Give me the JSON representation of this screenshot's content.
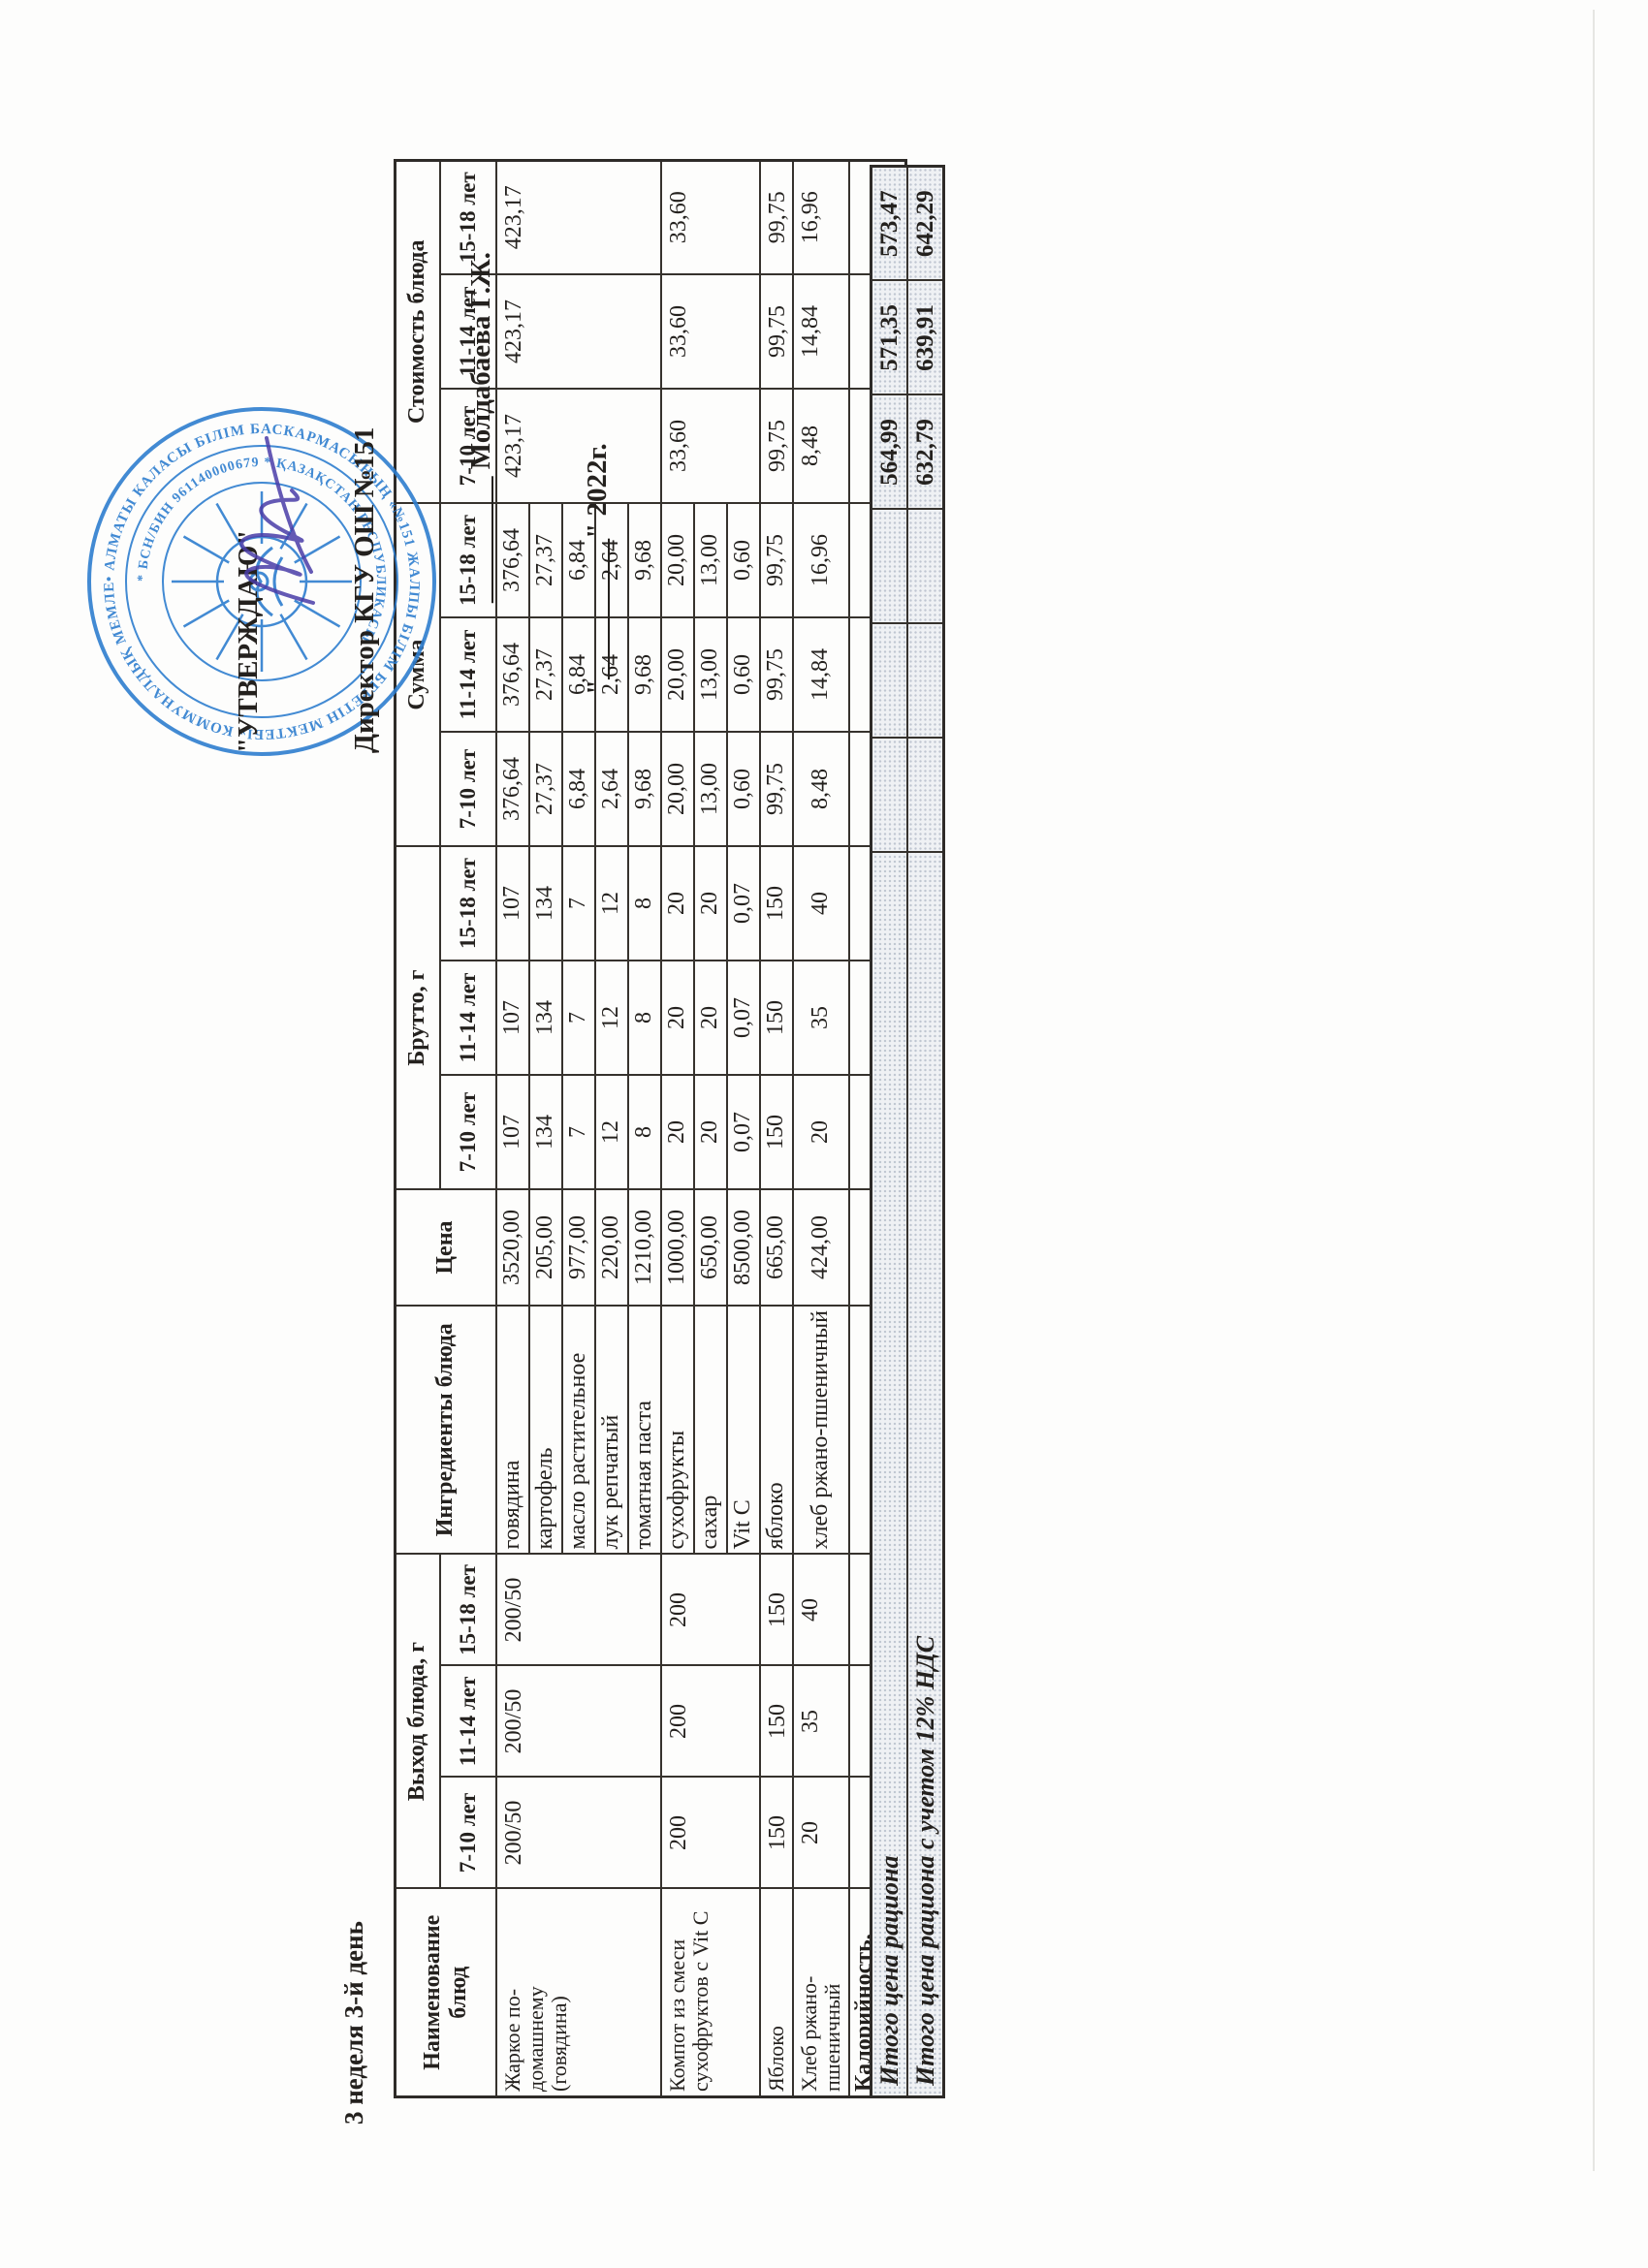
{
  "page": {
    "title": "3 неделя 3-й день"
  },
  "approval": {
    "line1": "\"УТВЕРЖДАЮ\"",
    "line2": "Директор КГУ ОШ №151",
    "line3": "_________ Молдабаева Г.Ж.",
    "line4": "\"__________\" 2022г."
  },
  "seal": {
    "color": "#2e7ecf",
    "ring_outer_text": "• АЛМАТЫ КАЛАСЫ БІЛІМ БАСКАРМАСЫНЫҢ «№151 ЖАЛПЫ БІЛІМ БЕРЕТІН МЕКТЕБІ» КОММУНАЛДЫҚ МЕМЛЕКЕТТІК МЕКЕМЕСІ •",
    "ring_inner_text": "* БСН/БИН 961140000679 * ҚАЗАҚСТАН РЕСПУБЛИКАСЫ"
  },
  "table": {
    "headers": {
      "name": "Наименование блюд",
      "yield": "Выход блюда, г",
      "ingredients": "Ингредиенты блюда",
      "price": "Цена",
      "brutto": "Брутто, г",
      "sum": "Сумма",
      "cost": "Стоимость блюда"
    },
    "age_groups": [
      "7-10 лет",
      "11-14 лет",
      "15-18 лет"
    ],
    "dishes": [
      {
        "name": "Жаркое по-домашнему (говядина)",
        "yield": [
          "200/50",
          "200/50",
          "200/50"
        ],
        "cost": [
          "423,17",
          "423,17",
          "423,17"
        ],
        "ingredients": [
          {
            "name": "говядина",
            "price": "3520,00",
            "brutto": [
              "107",
              "107",
              "107"
            ],
            "sum": [
              "376,64",
              "376,64",
              "376,64"
            ]
          },
          {
            "name": "картофель",
            "price": "205,00",
            "brutto": [
              "134",
              "134",
              "134"
            ],
            "sum": [
              "27,37",
              "27,37",
              "27,37"
            ]
          },
          {
            "name": "масло растительное",
            "price": "977,00",
            "brutto": [
              "7",
              "7",
              "7"
            ],
            "sum": [
              "6,84",
              "6,84",
              "6,84"
            ]
          },
          {
            "name": "лук репчатый",
            "price": "220,00",
            "brutto": [
              "12",
              "12",
              "12"
            ],
            "sum": [
              "2,64",
              "2,64",
              "2,64"
            ]
          },
          {
            "name": "томатная паста",
            "price": "1210,00",
            "brutto": [
              "8",
              "8",
              "8"
            ],
            "sum": [
              "9,68",
              "9,68",
              "9,68"
            ]
          }
        ]
      },
      {
        "name": "Компот из смеси сухофруктов с Vit C",
        "yield": [
          "200",
          "200",
          "200"
        ],
        "cost": [
          "33,60",
          "33,60",
          "33,60"
        ],
        "ingredients": [
          {
            "name": "сухофрукты",
            "price": "1000,00",
            "brutto": [
              "20",
              "20",
              "20"
            ],
            "sum": [
              "20,00",
              "20,00",
              "20,00"
            ]
          },
          {
            "name": "сахар",
            "price": "650,00",
            "brutto": [
              "20",
              "20",
              "20"
            ],
            "sum": [
              "13,00",
              "13,00",
              "13,00"
            ]
          },
          {
            "name": "Vit C",
            "price": "8500,00",
            "brutto": [
              "0,07",
              "0,07",
              "0,07"
            ],
            "sum": [
              "0,60",
              "0,60",
              "0,60"
            ]
          }
        ]
      },
      {
        "name": "Яблоко",
        "yield": [
          "150",
          "150",
          "150"
        ],
        "cost": [
          "99,75",
          "99,75",
          "99,75"
        ],
        "ingredients": [
          {
            "name": "яблоко",
            "price": "665,00",
            "brutto": [
              "150",
              "150",
              "150"
            ],
            "sum": [
              "99,75",
              "99,75",
              "99,75"
            ]
          }
        ]
      },
      {
        "name": "Хлеб ржано-пшеничный",
        "yield": [
          "20",
          "35",
          "40"
        ],
        "cost": [
          "8,48",
          "14,84",
          "16,96"
        ],
        "ingredients": [
          {
            "name": "хлеб ржано-пшеничный",
            "price": "424,00",
            "brutto": [
              "20",
              "35",
              "40"
            ],
            "sum": [
              "8,48",
              "14,84",
              "16,96"
            ]
          }
        ]
      }
    ],
    "kcal_row_label": "Калорийность, ккал",
    "summary_rows": [
      {
        "label": "Итого цена рациона",
        "values": [
          "564,99",
          "571,35",
          "573,47"
        ]
      },
      {
        "label": "Итого цена рациона с учетом 12% НДС",
        "values": [
          "632,79",
          "639,91",
          "642,29"
        ]
      }
    ]
  }
}
